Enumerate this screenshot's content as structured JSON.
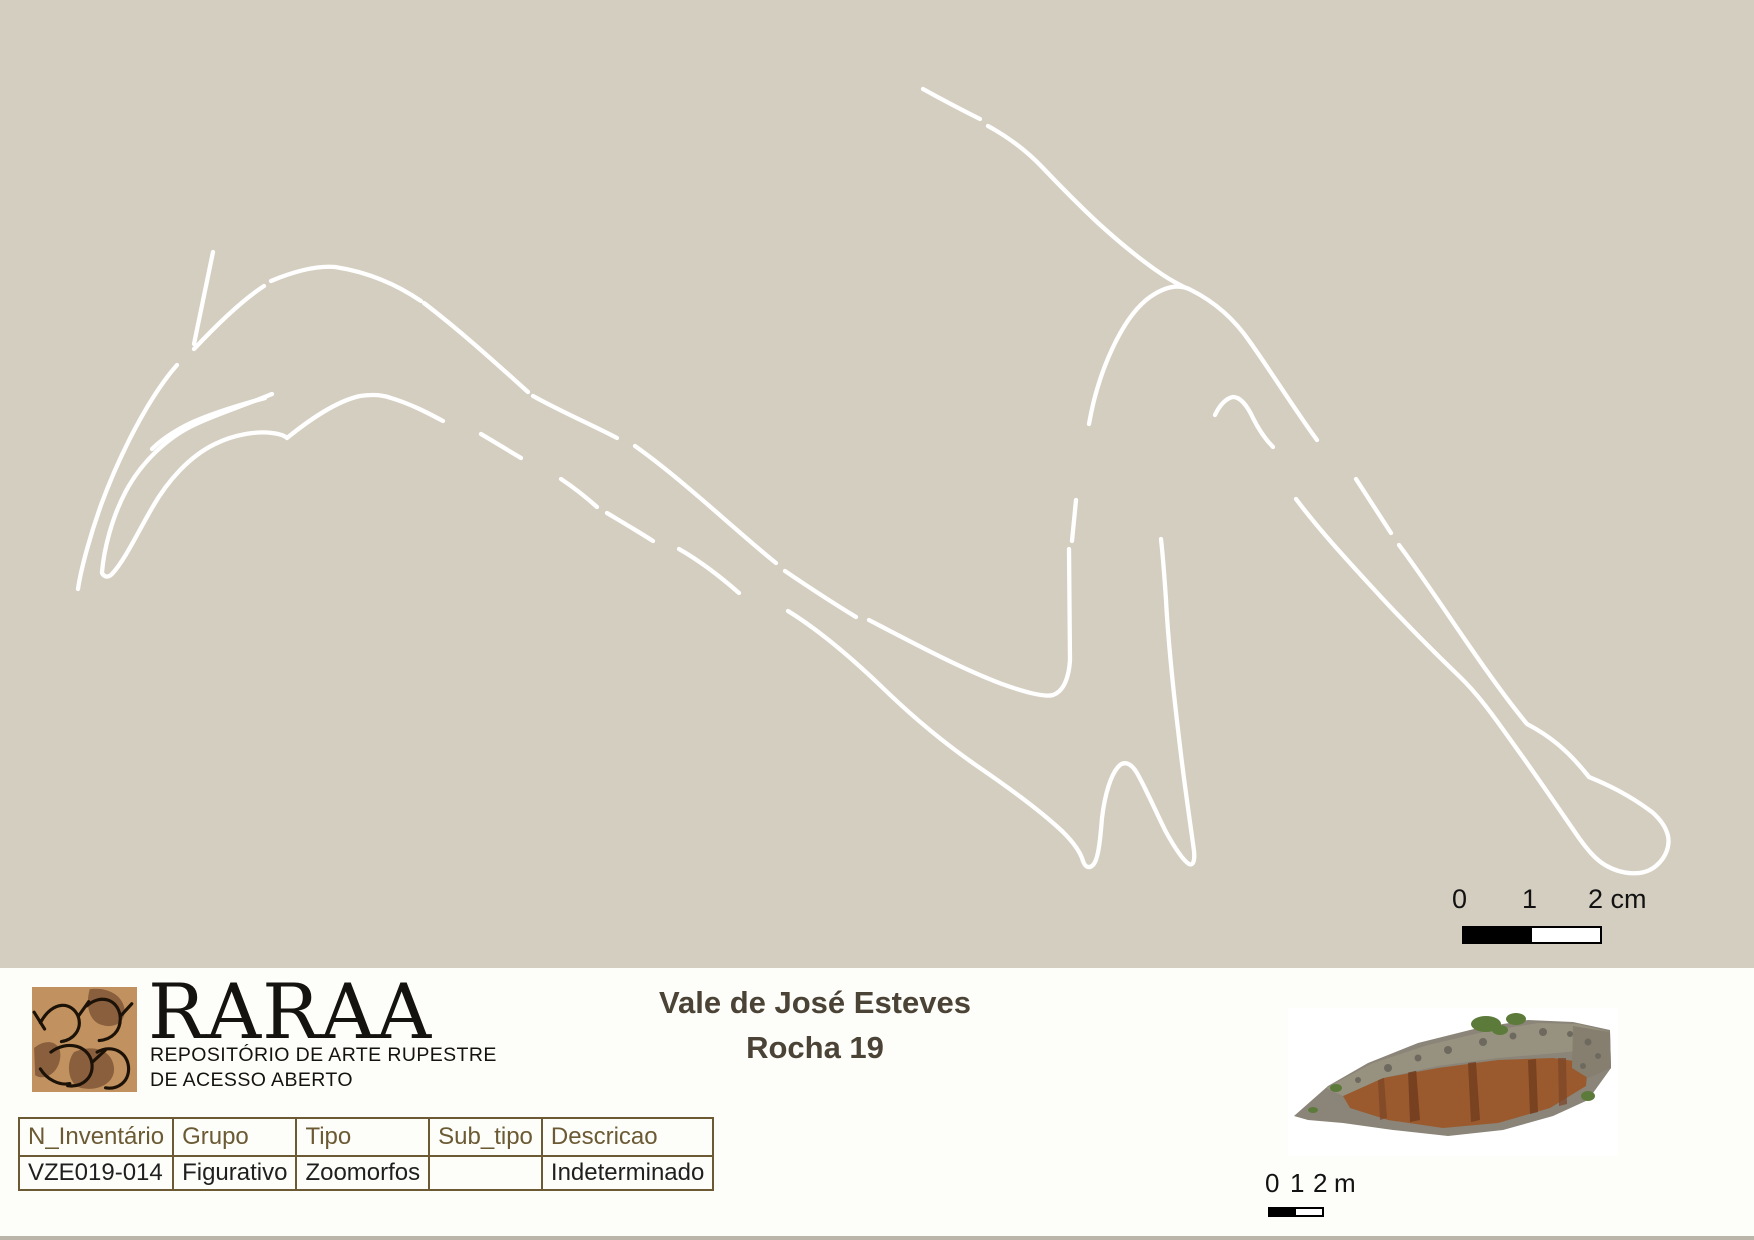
{
  "drawing": {
    "background": "#d4cec0",
    "stroke_color": "#ffffff",
    "stroke_width": 4.3,
    "subject": "zoomorph tracing, white outline on beige rock surface",
    "paths": [
      {
        "name": "ear-line",
        "d": "M213 252 L194 344"
      },
      {
        "name": "head-back-line",
        "d": "M194 349 C225 316 247 297 264 286"
      },
      {
        "name": "head-top-line",
        "d": "M271 281 C302 268 322 266 335 267 C368 272 396 284 421 301"
      },
      {
        "name": "neck-top-dash-1",
        "d": "M424 303 C463 333 498 365 528 392"
      },
      {
        "name": "neck-top-dash-2",
        "d": "M533 396 C562 412 590 424 617 438"
      },
      {
        "name": "neck-top-dash-3",
        "d": "M635 446 C683 480 735 530 776 563"
      },
      {
        "name": "neck-top-dash-4",
        "d": "M785 571 C810 588 833 603 856 617"
      },
      {
        "name": "belly-line",
        "d": "M869 620 C915 644 962 669 1002 684 C1030 694 1046 697 1053 695 C1064 691 1069 677 1070 660 L1069 549"
      },
      {
        "name": "belly-dash",
        "d": "M1072 541 L1076 500"
      },
      {
        "name": "rump-arch-line",
        "d": "M1089 424 C1098 372 1122 317 1150 297 C1166 286 1180 284 1191 290 C1215 302 1235 320 1250 342 C1272 373 1295 410 1317 440"
      },
      {
        "name": "back-line-a",
        "d": "M923 89 C941 99 958 108 980 119"
      },
      {
        "name": "back-line-b",
        "d": "M988 126 C1010 138 1028 152 1043 168 C1062 188 1080 206 1097 222 C1120 243 1145 263 1163 275 C1172 281 1180 285 1186 288"
      },
      {
        "name": "rump-inner-line",
        "d": "M1215 415 C1220 404 1227 398 1233 397 C1240 397 1247 405 1253 418 C1259 430 1266 440 1273 447"
      },
      {
        "name": "front-legs-line",
        "d": "M788 611 C822 632 855 661 885 690 C915 719 948 746 980 768 C1015 792 1045 815 1063 832 C1075 844 1081 854 1083 861 C1085 867 1089 869 1093 865 C1098 860 1100 843 1102 818 C1105 793 1111 775 1118 767 C1124 760 1131 763 1137 773 C1146 789 1156 812 1166 832 C1176 850 1184 861 1189 864 C1193 866 1195 861 1194 851 C1191 828 1185 790 1179 738 C1173 688 1168 638 1166 600 C1164 570 1162 548 1161 539"
      },
      {
        "name": "throat-dash-1",
        "d": "M481 434 L521 458"
      },
      {
        "name": "throat-dash-2",
        "d": "M561 479 C576 489 587 498 597 507"
      },
      {
        "name": "throat-dash-3",
        "d": "M607 513 C622 522 639 532 653 541"
      },
      {
        "name": "throat-dash-4",
        "d": "M679 549 C700 561 722 578 739 593"
      },
      {
        "name": "jaw-throat-line",
        "d": "M102 573 C104 577 108 578 112 574 C125 560 138 532 152 508 C168 480 190 456 215 444 C235 434 258 431 272 433 C280 434 285 436 287 438 C309 420 337 401 360 396 C374 394 383 395 391 398 C411 404 428 413 443 421"
      },
      {
        "name": "face-front-line",
        "d": "M177 365 C148 398 119 456 101 505 C91 533 81 568 78 589"
      },
      {
        "name": "muzzle-top-line",
        "d": "M272 394 C243 406 217 414 196 424 C167 437 141 463 126 491 C112 517 104 549 102 572"
      },
      {
        "name": "muzzle-double-line",
        "d": "M265 398 C243 404 220 411 200 419 C182 426 163 438 152 449"
      },
      {
        "name": "hind-leg-dash",
        "d": "M1356 479 L1391 533"
      },
      {
        "name": "hind-leg-hoof-line",
        "d": "M1296 499 C1320 531 1348 561 1381 597 C1410 628 1437 655 1459 676 C1481 697 1499 724 1517 749 C1538 778 1561 812 1579 838 C1587 849 1595 859 1605 865 C1622 875 1644 877 1657 865 C1666 857 1670 846 1668 836 C1666 827 1660 819 1652 812 C1628 794 1606 784 1589 777 C1567 749 1548 735 1527 724 C1508 701 1490 676 1468 644 C1446 612 1420 573 1399 545"
      }
    ],
    "scale_cm": {
      "tick0": "0",
      "tick1": "1",
      "tick2": "2 cm"
    }
  },
  "footer": {
    "background": "#fdfdfa",
    "logo": {
      "acronym": "RARAA",
      "line1": "REPOSITÓRIO DE ARTE RUPESTRE",
      "line2": "DE ACESSO ABERTO",
      "tile_color": "#c1925f",
      "patch_color": "#8a5f3e",
      "outline_color": "#1c1208"
    },
    "title": {
      "line1": "Vale de José Esteves",
      "line2": "Rocha 19",
      "color": "#4a4336"
    },
    "table": {
      "border_color": "#6b5a33",
      "header_color": "#6b5a33",
      "cell_color": "#1f1f1f",
      "headers": [
        "N_Inventário",
        "Grupo",
        "Tipo",
        "Sub_tipo",
        "Descricao"
      ],
      "row": [
        "VZE019-014",
        "Figurativo",
        "Zoomorfos",
        "",
        "Indeterminado"
      ]
    },
    "scale_m": {
      "tick0": "0",
      "tick1": "1",
      "tick2": "2",
      "unit": "m"
    }
  }
}
